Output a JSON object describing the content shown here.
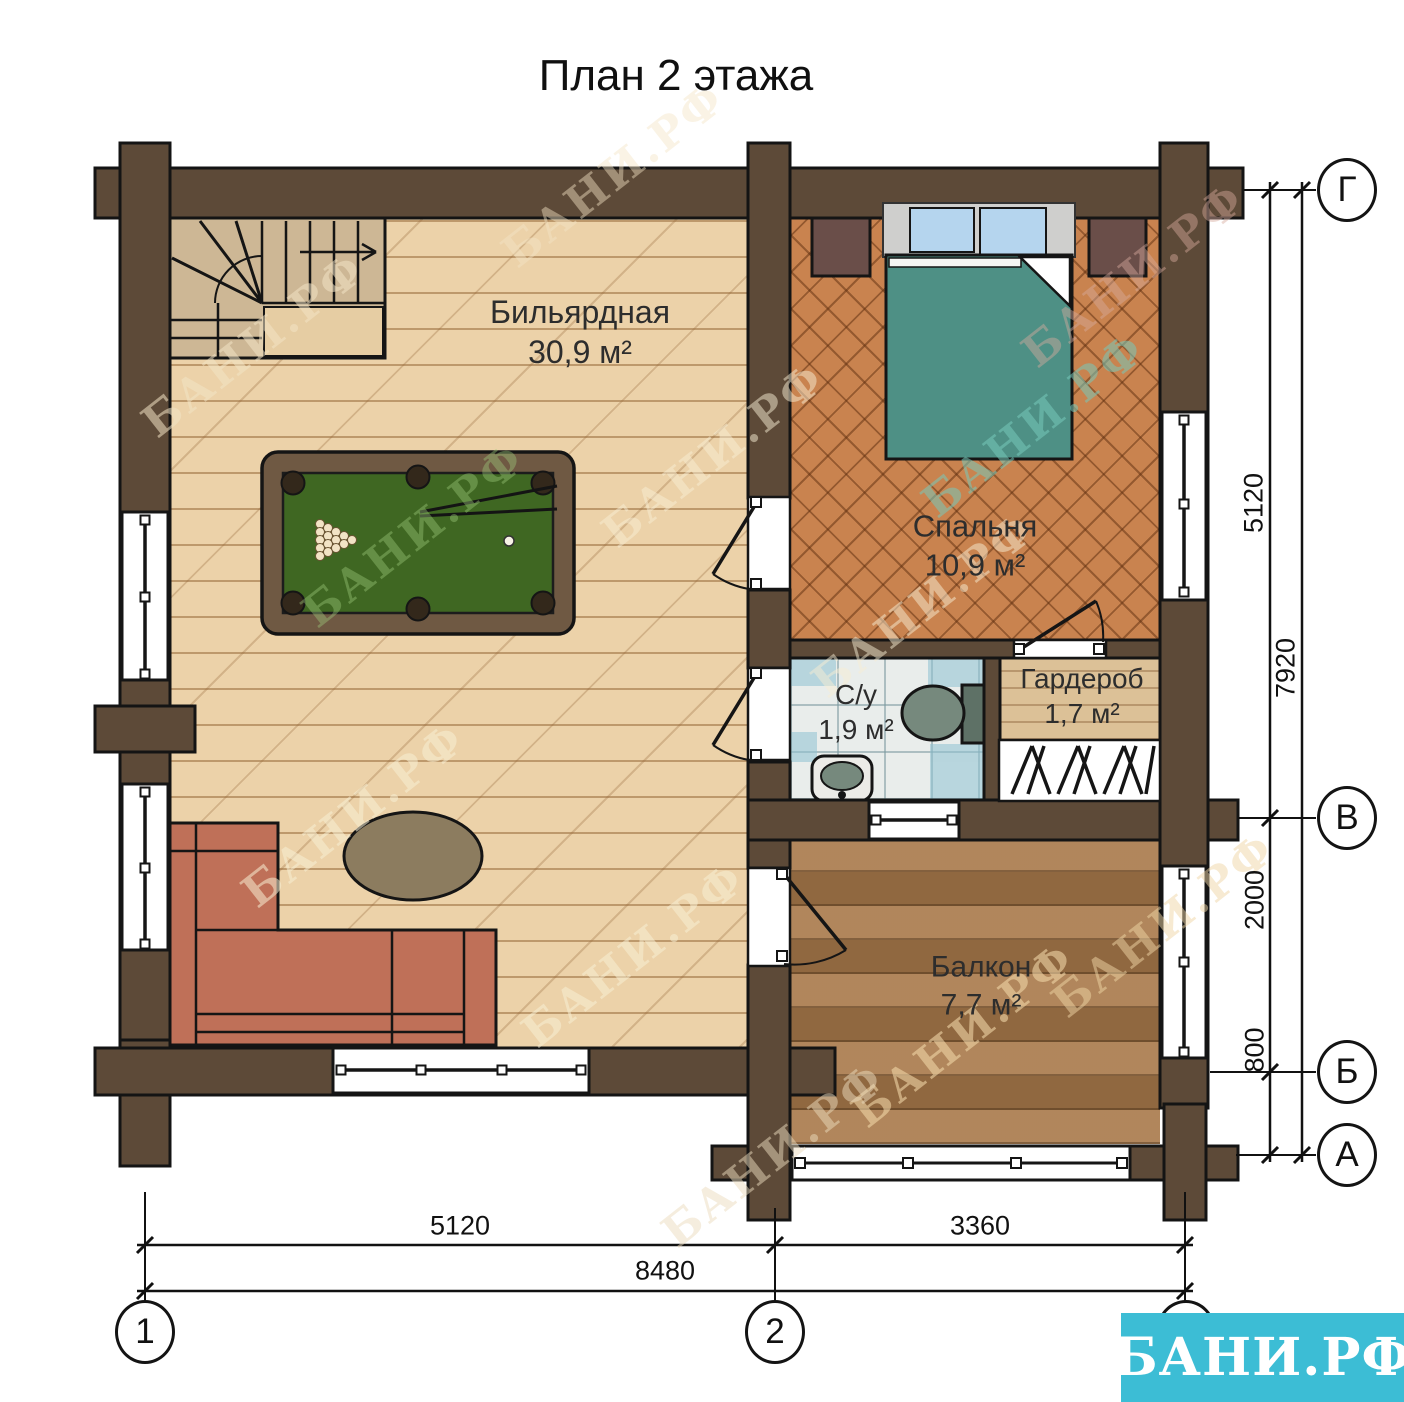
{
  "title": "План 2 этажа",
  "rooms": {
    "billiard": {
      "name": "Бильярдная",
      "area": "30,9 м²"
    },
    "bedroom": {
      "name": "Спальня",
      "area": "10,9 м²"
    },
    "bathroom": {
      "name": "С/у",
      "area": "1,9 м²"
    },
    "wardrobe": {
      "name": "Гардероб",
      "area": "1,7 м²"
    },
    "balcony": {
      "name": "Балкон",
      "area": "7,7 м²"
    }
  },
  "dimensions": {
    "right_top": "5120",
    "right_mid": "2000",
    "right_bottom": "800",
    "right_total": "7920",
    "bottom_left": "5120",
    "bottom_right": "3360",
    "bottom_total": "8480"
  },
  "axes": {
    "row_g": "Г",
    "row_v": "В",
    "row_b": "Б",
    "row_a": "А",
    "col_1": "1",
    "col_2": "2",
    "col_3": "3"
  },
  "logo": {
    "text": "БАНИ.РФ",
    "color": "#3cbdd5"
  },
  "watermark": "БАНИ.РФ",
  "colors": {
    "wall": "#5d4a38",
    "accent": "#3cbdd5",
    "bed": "#4e9085",
    "felt": "#3f6722",
    "sofa": "#bf7058"
  }
}
